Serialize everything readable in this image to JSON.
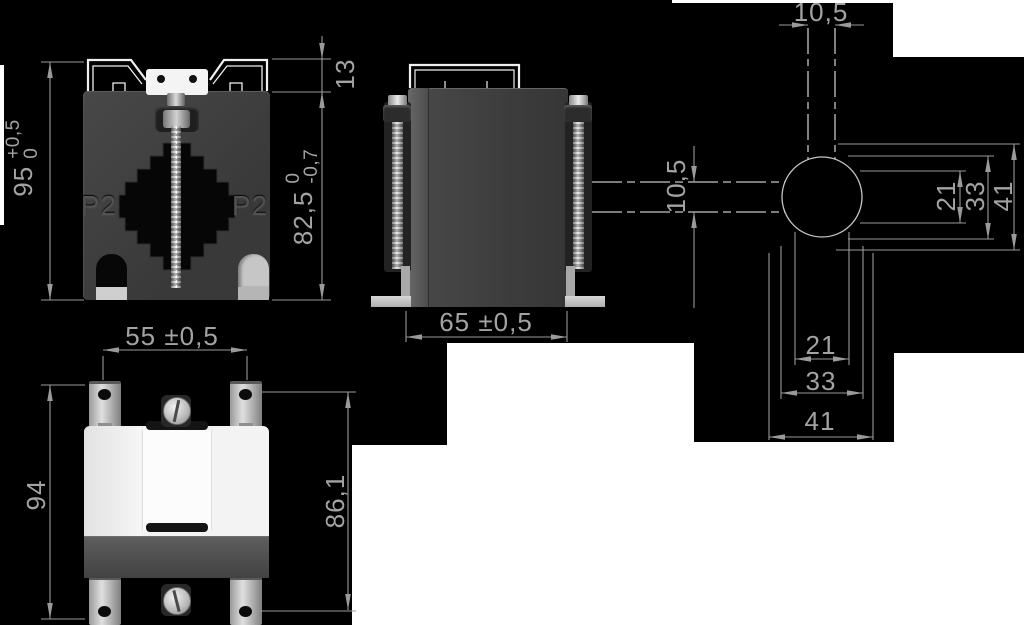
{
  "front_view": {
    "core_label_left": "P2",
    "core_label_right": "P2",
    "dim_overall_height": {
      "value": "95",
      "tol_upper": "+0,5",
      "tol_lower": "0"
    },
    "dim_clip_height": "13",
    "dim_body_height": {
      "value": "82,5",
      "tol_upper": "0",
      "tol_lower": "-0,7"
    }
  },
  "side_view": {
    "dim_width": "65 ±0,5"
  },
  "top_view": {
    "dim_foot_spacing": "55 ±0,5",
    "dim_overall_depth": "94",
    "dim_hole_pitch": "86,1"
  },
  "hole_pattern": {
    "dim_slot_width_top": "10,5",
    "dim_slot_width_side": "10,5",
    "dim_vertical_inner": "21",
    "dim_vertical_mid": "33",
    "dim_vertical_outer": "41",
    "dim_horizontal_inner": "21",
    "dim_horizontal_mid": "33",
    "dim_horizontal_outer": "41"
  },
  "colors": {
    "background": "#000000",
    "dimension_lines": "#9a9a9a",
    "dimension_text": "#a3a3a3",
    "geometry_lines": "#c5c5c5",
    "body_dark_gray": "#3f3f3f",
    "clip_white": "#f2f2f2",
    "metal_light": "#d8d8d8"
  }
}
